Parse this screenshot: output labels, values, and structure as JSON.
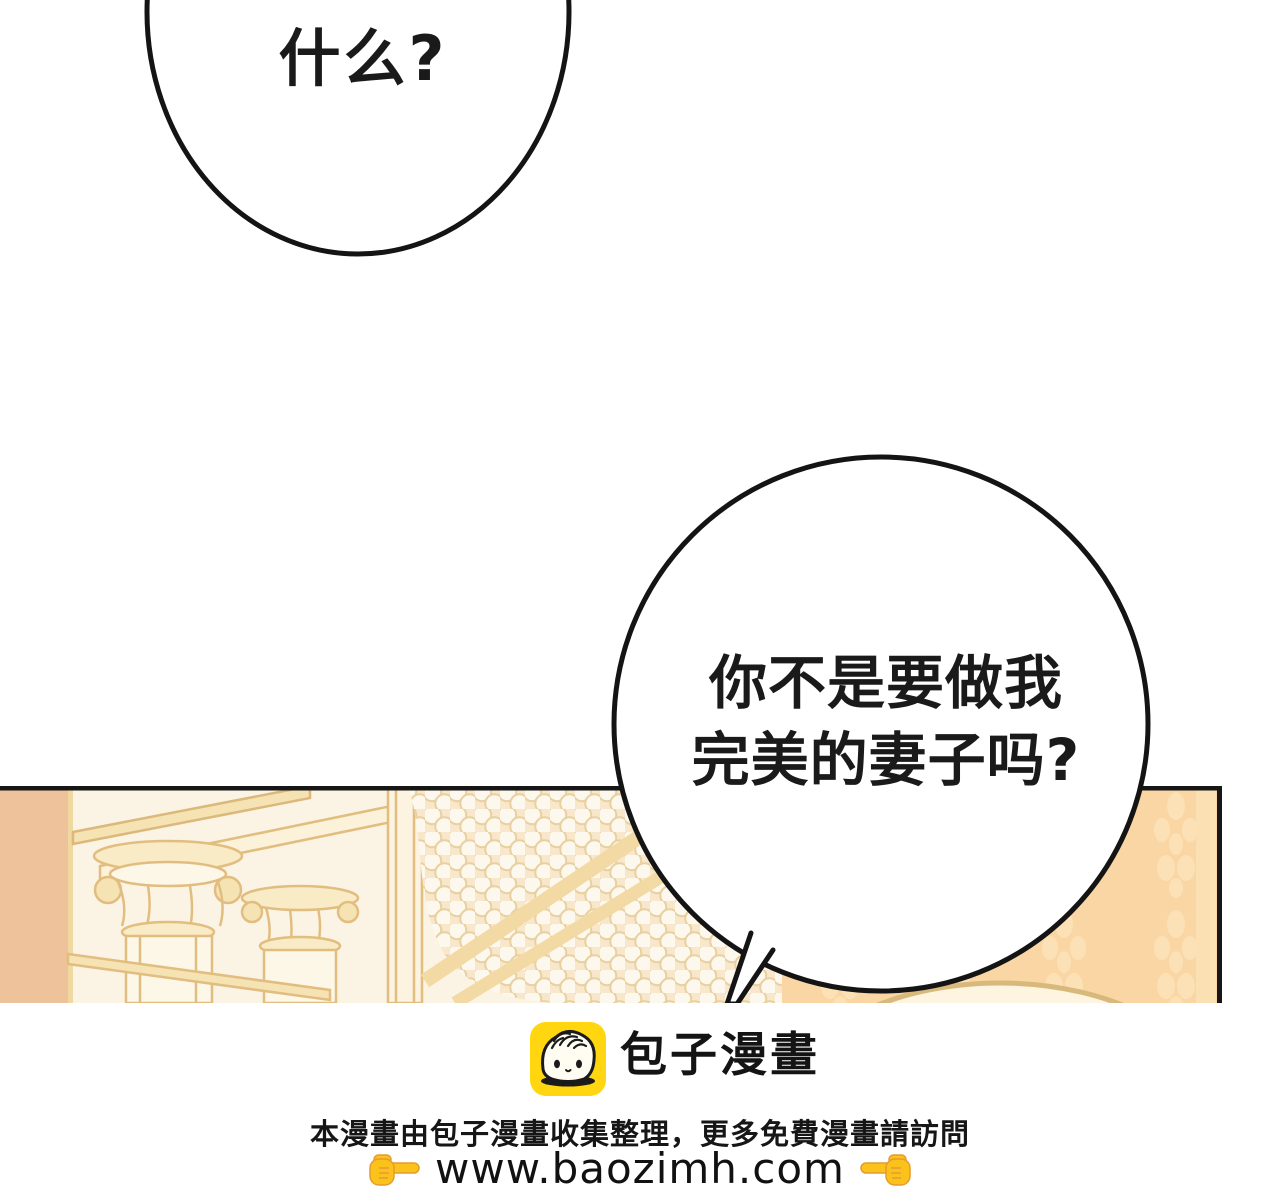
{
  "speech_bubbles": {
    "top_bubble": {
      "text": "什么?"
    },
    "main_bubble": {
      "line1": "你不是要做我",
      "line2": "完美的妻子吗?"
    }
  },
  "footer": {
    "logo_icon": "baozi-bun-face",
    "brand_name": "包子漫畫",
    "notice": "本漫畫由包子漫畫收集整理，更多免費漫畫請訪問",
    "url": "www.baozimh.com",
    "point_right_icon": "backhand-index-pointing-right",
    "point_left_icon": "backhand-index-pointing-left"
  },
  "colors": {
    "outline_black": "#161616",
    "panel_cream": "#fbf4e4",
    "peach_strip": "#eec29b",
    "gold_line": "#e2bd80",
    "gold_fill": "#f6e3b4",
    "bead_bg": "#f8e7ca",
    "bead_fill": "#fdf8ed",
    "damask_wall": "#f9d6a3",
    "damask_motif": "#fce1b6",
    "logo_yellow": "#ffd60f"
  }
}
